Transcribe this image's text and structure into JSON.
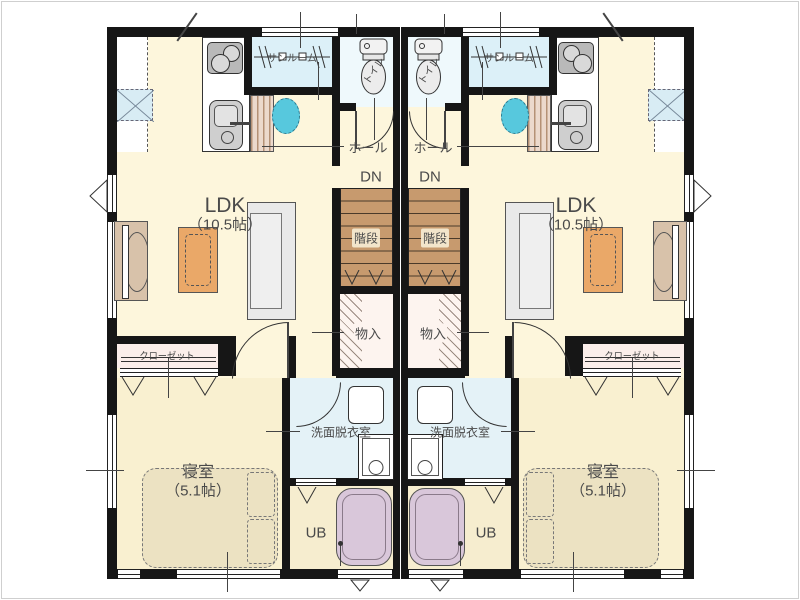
{
  "plan_type": "duplex-floor-plan",
  "labels": {
    "ldk": "LDK",
    "ldk_size": "（10.5帖）",
    "bedroom": "寝室",
    "bedroom_size": "（5.1帖）",
    "hall": "ホール",
    "down": "DN",
    "stairs": "階段",
    "storage": "物入",
    "closet": "クローゼット",
    "washroom": "洗面脱衣室",
    "unit_bath": "UB",
    "toilet": "トイレ",
    "sunroom": "サンルーム"
  },
  "rooms": [
    {
      "name": "LDK",
      "size": "10.5帖",
      "count": 2
    },
    {
      "name": "寝室",
      "size": "5.1帖",
      "count": 2
    },
    {
      "name": "サンルーム",
      "count": 2
    },
    {
      "name": "トイレ",
      "count": 2
    },
    {
      "name": "洗面脱衣室",
      "count": 2
    },
    {
      "name": "UB",
      "count": 2
    },
    {
      "name": "物入",
      "count": 2
    },
    {
      "name": "クローゼット",
      "count": 2
    },
    {
      "name": "階段",
      "count": 2
    },
    {
      "name": "ホール",
      "count": 2
    }
  ],
  "palette": {
    "wall": "#161616",
    "ldk_floor": "#fdf6dc",
    "bedroom_floor": "#f9f0d0",
    "wet_floor": "#e4f2f7",
    "sunroom_floor": "#dcf0f8",
    "toilet_floor": "#eff9fc",
    "bath_floor": "#f6edcf",
    "stairs": "#c79a6e",
    "table": "#eaa868",
    "tub": "#d9c7da",
    "bed": "#ece2c2",
    "closet": "#fbeeea",
    "tv_board": "#d8c2aa",
    "accent_cyan": "#57c8dd"
  }
}
